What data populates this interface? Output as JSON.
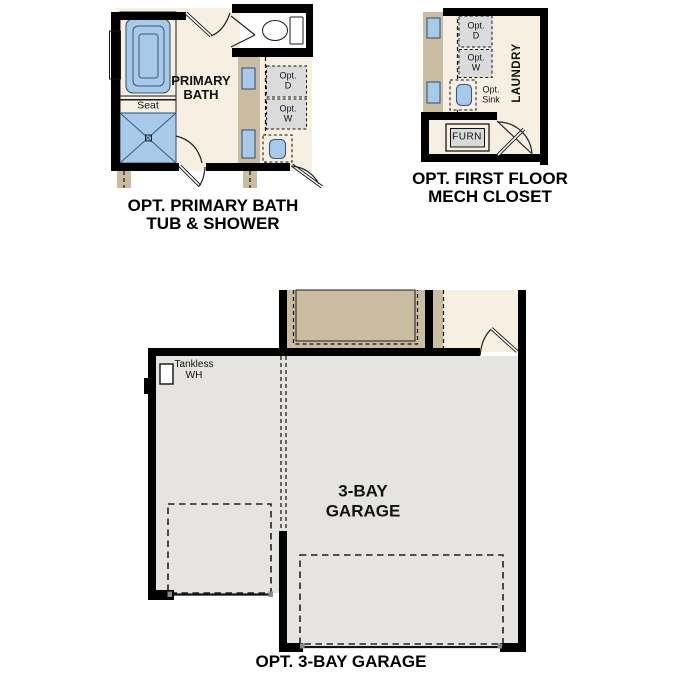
{
  "colors": {
    "floor_cream": "#f7f0e2",
    "wall_black": "#000000",
    "wall_tan": "#c9bca1",
    "fixture_blue": "#a9c9e9",
    "garage_floor_gray": "#e5e4e1",
    "opt_box_gray": "#dbdbdb",
    "text": "#111111"
  },
  "panels": {
    "primary_bath": {
      "caption": "OPT. PRIMARY BATH\nTUB & SHOWER",
      "room_label": "PRIMARY\nBATH",
      "seat_label": "Seat",
      "opt_dryer_label": "Opt.\nD",
      "opt_washer_label": "Opt.\nW"
    },
    "mech_closet": {
      "caption": "OPT. FIRST FLOOR\nMECH CLOSET",
      "laundry_label": "LAUNDRY",
      "furnace_label": "FURN",
      "opt_dryer_label": "Opt.\nD",
      "opt_washer_label": "Opt.\nW",
      "opt_sink_label": "Opt.\nSink"
    },
    "garage": {
      "caption": "OPT. 3-BAY GARAGE",
      "room_label": "3-BAY\nGARAGE",
      "tankless_water_heater_label": "Tankless\nWH"
    }
  }
}
